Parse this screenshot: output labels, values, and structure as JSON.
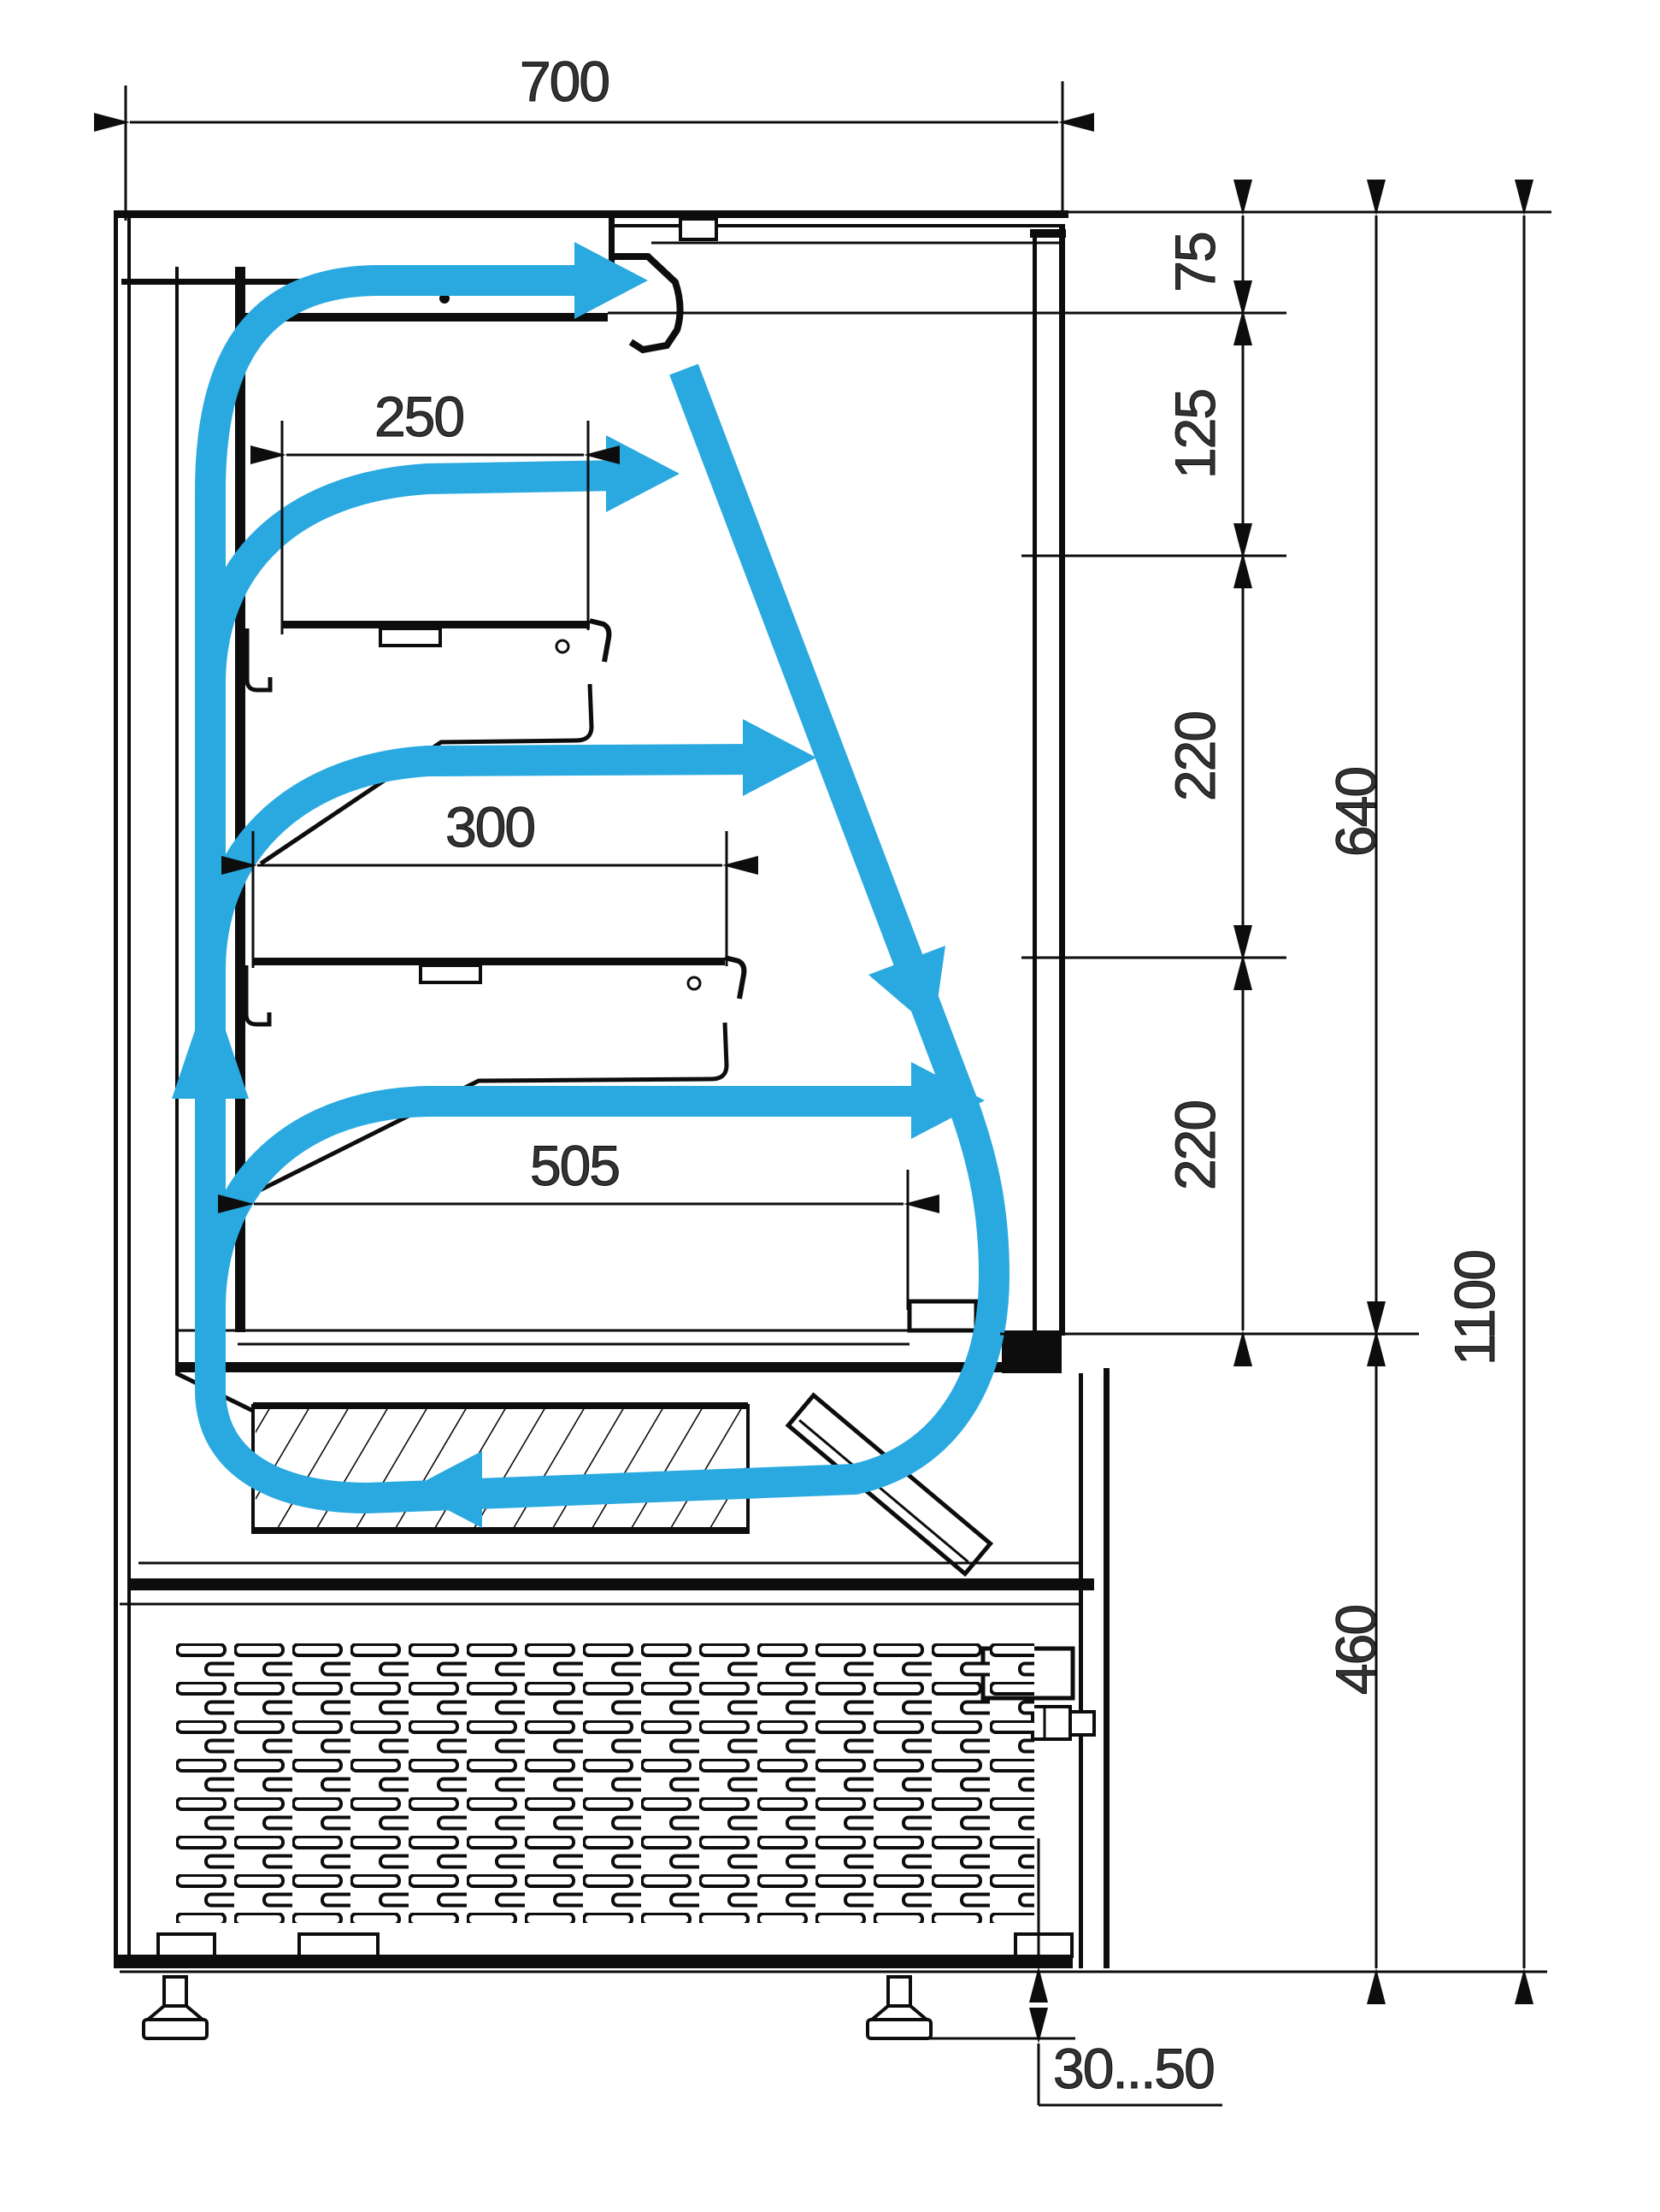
{
  "diagram": {
    "kind": "refrigerated-display-case-cross-section",
    "style": "2D engineering drawing, side section view, airflow schematic",
    "colors": {
      "line": "#0d0d0d",
      "airflow_accent": "#2AA9E0",
      "background": "#ffffff"
    },
    "dims": {
      "d700": "700",
      "d250": "250",
      "d300": "300",
      "d505": "505",
      "d75": "75",
      "d125": "125",
      "d220a": "220",
      "d220b": "220",
      "d640": "640",
      "d1100": "1100",
      "d460": "460",
      "foot_range": "30...50"
    },
    "dimension_meanings": {
      "d700": "overall depth of case (top)",
      "d250": "upper shelf depth",
      "d300": "middle shelf depth",
      "d505": "bottom display deck depth",
      "d75": "air discharge gap below top",
      "d125": "canopy to first shelf level",
      "d220a": "first to second shelf level",
      "d220b": "second shelf to deck level",
      "d640": "display opening height",
      "d1100": "display section overall height",
      "d460": "machine compartment height",
      "foot_range": "adjustable foot height range"
    },
    "airflow": {
      "loop": "air rises in rear duct, discharges from canopy nozzle and above each shelf, falls along front glass, returns left through evaporator, loops up rear duct",
      "arrows": [
        "canopy-discharge-right",
        "shelf1-discharge-right",
        "shelf2-discharge-right",
        "deck-discharge-right",
        "front-glass-down-diagonal",
        "return-left-through-evaporator",
        "rear-duct-up"
      ]
    },
    "components": [
      "canopy-air-duct",
      "discharge-nozzle",
      "front-glass-panel",
      "rear-air-duct",
      "shelf-1",
      "shelf-2",
      "display-deck",
      "evaporator-hatched-block",
      "tilted-fan-panel",
      "machine-compartment",
      "ventilation-grille",
      "thermostat-box",
      "adjustable-feet",
      "floor-reference-line"
    ]
  }
}
